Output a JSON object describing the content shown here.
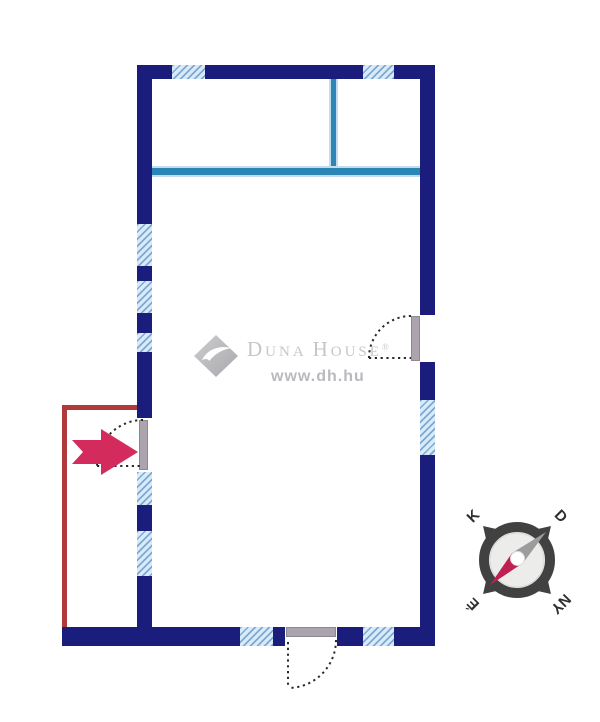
{
  "watermark": {
    "brand_part1": "D",
    "brand_part2": "UNA ",
    "brand_part3": "H",
    "brand_part4": "OUSE",
    "registered_mark": "®",
    "website": "www.dh.hu"
  },
  "compass": {
    "north": "É",
    "south": "D",
    "east": "K",
    "west": "NY"
  },
  "icons": {
    "logo": "duna-house-diamond-swoosh",
    "entrance": "right-arrow",
    "orientation": "compass-rose"
  },
  "colors": {
    "wall": "#1a1d7b",
    "partition": "#2b86b5",
    "partition_halo": "#c3ddee",
    "window_fill": "#d9ebf9",
    "window_stripe": "#7fa9d3",
    "annex": "#b03a3a",
    "arrow": "#d42b5d",
    "door": "#aba3ad",
    "swing": "#2a2a2a",
    "compass_ring": "#414141",
    "compass_face": "#ececea",
    "needle_north": "#c02050",
    "needle_south": "#9c9c9c",
    "watermark_text": "#c6c6ca",
    "watermark_url": "#b9b9bf",
    "letters": "#2f2f2f"
  }
}
